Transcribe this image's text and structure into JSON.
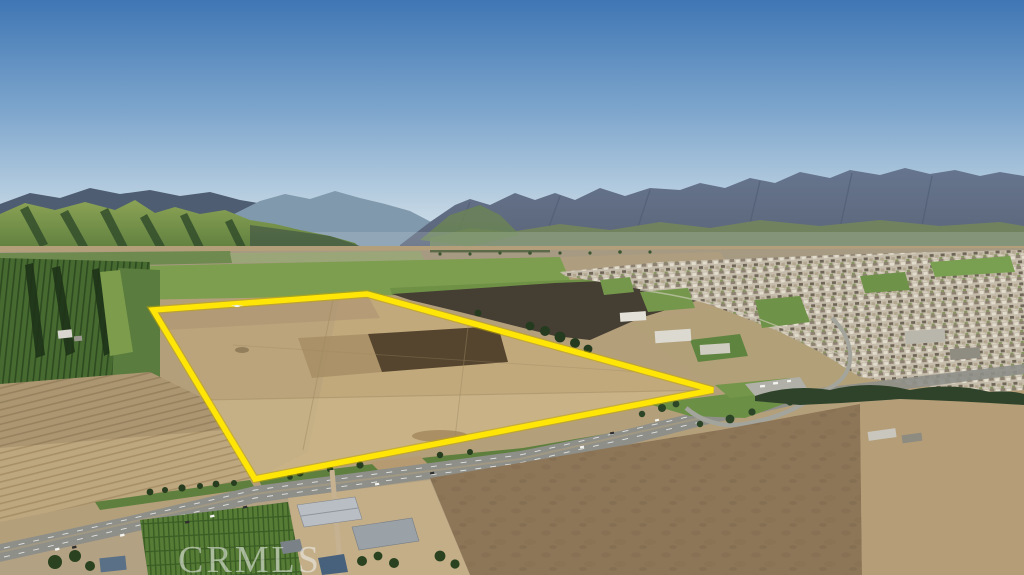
{
  "image": {
    "kind": "aerial-drone-photograph",
    "subject": "Large plowed farmland parcel outlined in yellow beside a highway interchange and a small town, with green hills, a hazy mountain range and clear blue sky",
    "width_px": 1024,
    "height_px": 575
  },
  "watermark": {
    "text": "CRMLS"
  },
  "property_outline": {
    "shape": "quadrilateral",
    "vertices_px": [
      [
        153,
        310
      ],
      [
        367,
        294
      ],
      [
        713,
        390
      ],
      [
        255,
        479
      ]
    ],
    "stroke_color": "#ffe607",
    "underglow_color": "#c3a800",
    "stroke_width_px": 5.5
  },
  "colors": {
    "property_outline": "#ffe607",
    "sky_top": "#3f76b4",
    "sky_mid": "#7fa7cd",
    "sky_horizon": "#d8e4ec",
    "mountain_slate": "#5f6d85",
    "hills_green": "#86a053",
    "valley_crop_green": "#7d9e4e",
    "plowed_tan": "#c2a97c",
    "tilled_dark_brown": "#453e33",
    "highway_gray": "#8e8f89",
    "vineyard_green": "#46692f",
    "town_mosaic_base": "#c5bcab",
    "tree_dark_green": "#2c4526"
  },
  "scene": {
    "regions": [
      {
        "name": "sky",
        "desc": "clear gradient blue sky"
      },
      {
        "name": "mountain-range-right",
        "desc": "hazy slate-blue mountain range with green foothills"
      },
      {
        "name": "green-hills-left",
        "desc": "sunlit yellow-green hills with dark shadowed folds"
      },
      {
        "name": "valley-fields",
        "desc": "patchwork of distant green and tan farm fields"
      },
      {
        "name": "town-right",
        "desc": "dense residential mosaic with parks and large gray buildings"
      },
      {
        "name": "outlined-parcel",
        "desc": "plowed tan parcel with dark tilled square, outlined in bright yellow"
      },
      {
        "name": "highway",
        "desc": "divided highway with interchange loop running diagonally across the foreground"
      },
      {
        "name": "vineyards-left",
        "desc": "dark green vineyard blocks with windbreak tree rows"
      },
      {
        "name": "furrow-fields-bottom-left",
        "desc": "tan plowed fields with diagonal furrow lines"
      },
      {
        "name": "farm-buildings-bottom",
        "desc": "gray-roofed barns, houses and a small vineyard along the road"
      }
    ]
  }
}
